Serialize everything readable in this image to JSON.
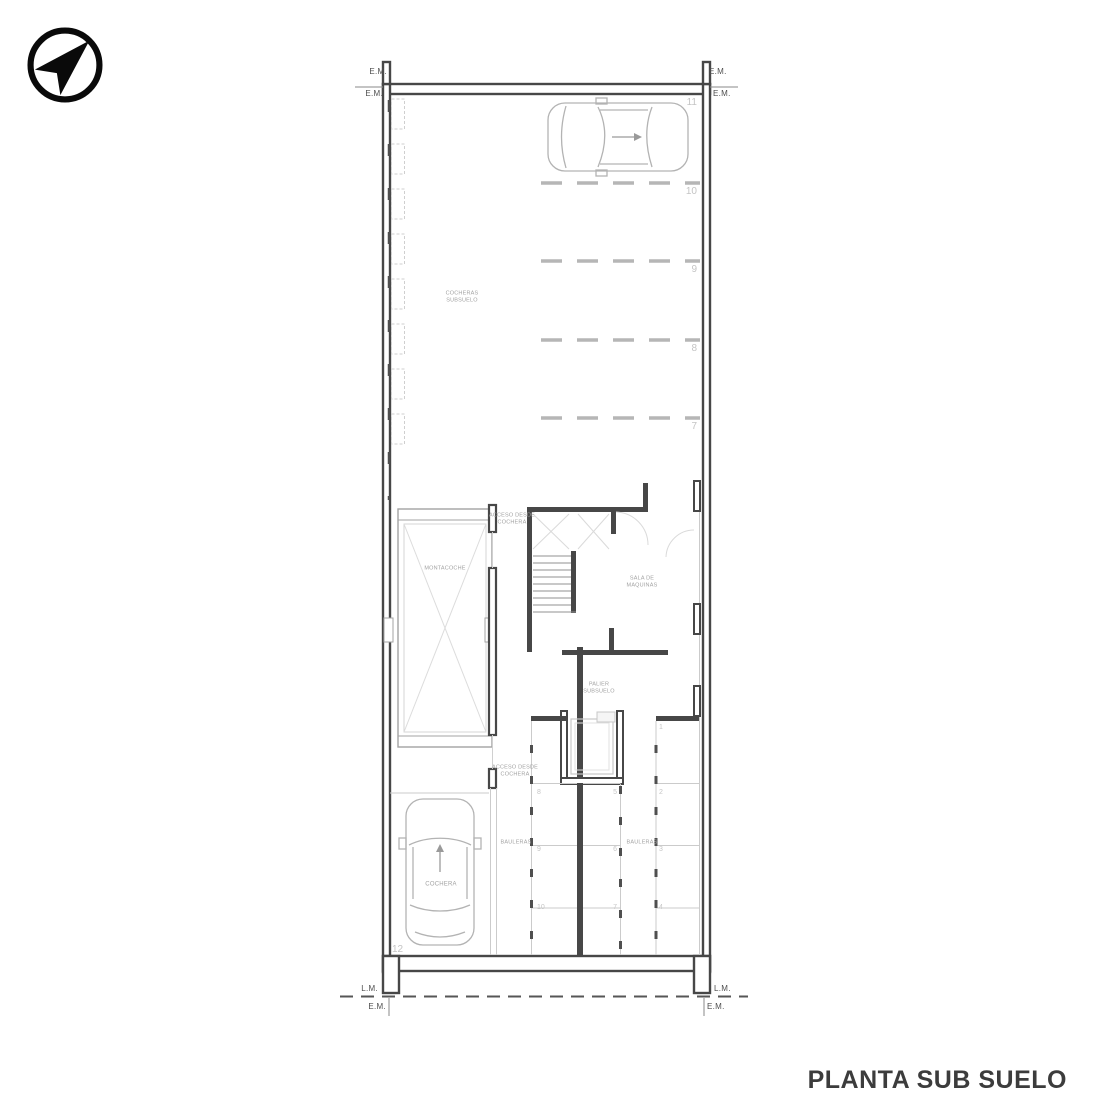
{
  "title": "PLANTA SUB SUELO",
  "compass": {
    "icon": "north-arrow"
  },
  "boundary": {
    "em_top_left_outer": "E.M.",
    "em_top_left_inner": "E.M.",
    "em_top_right_outer": "E.M.",
    "em_top_right_inner": "E.M.",
    "lm_bottom_left": "L.M.",
    "lm_bottom_right": "L.M.",
    "em_bottom_left": "E.M.",
    "em_bottom_right": "E.M."
  },
  "rooms": {
    "cocheras_label": "COCHERAS\nSUBSUELO",
    "montacoche_label": "MONTACOCHE",
    "acceso_top_label": "ACCESO DESDE\nCOCHERA",
    "acceso_bottom_label": "ACCESO DESDE\nCOCHERA",
    "sala_maquinas_label": "SALA DE\nMAQUINAS",
    "palier_label": "PALIER\nSUBSUELO",
    "bauleras_left_label": "BAULERAS",
    "bauleras_right_label": "BAULERAS",
    "cochera_label": "COCHERA"
  },
  "parking_spaces": {
    "p11": "11",
    "p10": "10",
    "p9": "9",
    "p8": "8",
    "p7": "7",
    "p12": "12"
  },
  "bauleras": {
    "b1": "1",
    "b2": "2",
    "b3": "3",
    "b4": "4",
    "b5": "5",
    "b6": "6",
    "b7": "7",
    "b8": "8",
    "b9": "9",
    "b10": "10"
  },
  "colors": {
    "wall_dark": "#474747",
    "line_medium": "#9c9c9c",
    "line_light": "#cbcbcb",
    "text_gray": "#a2a2a2",
    "number_gray": "#c4c4c4",
    "title_color": "#3c3c3c"
  }
}
